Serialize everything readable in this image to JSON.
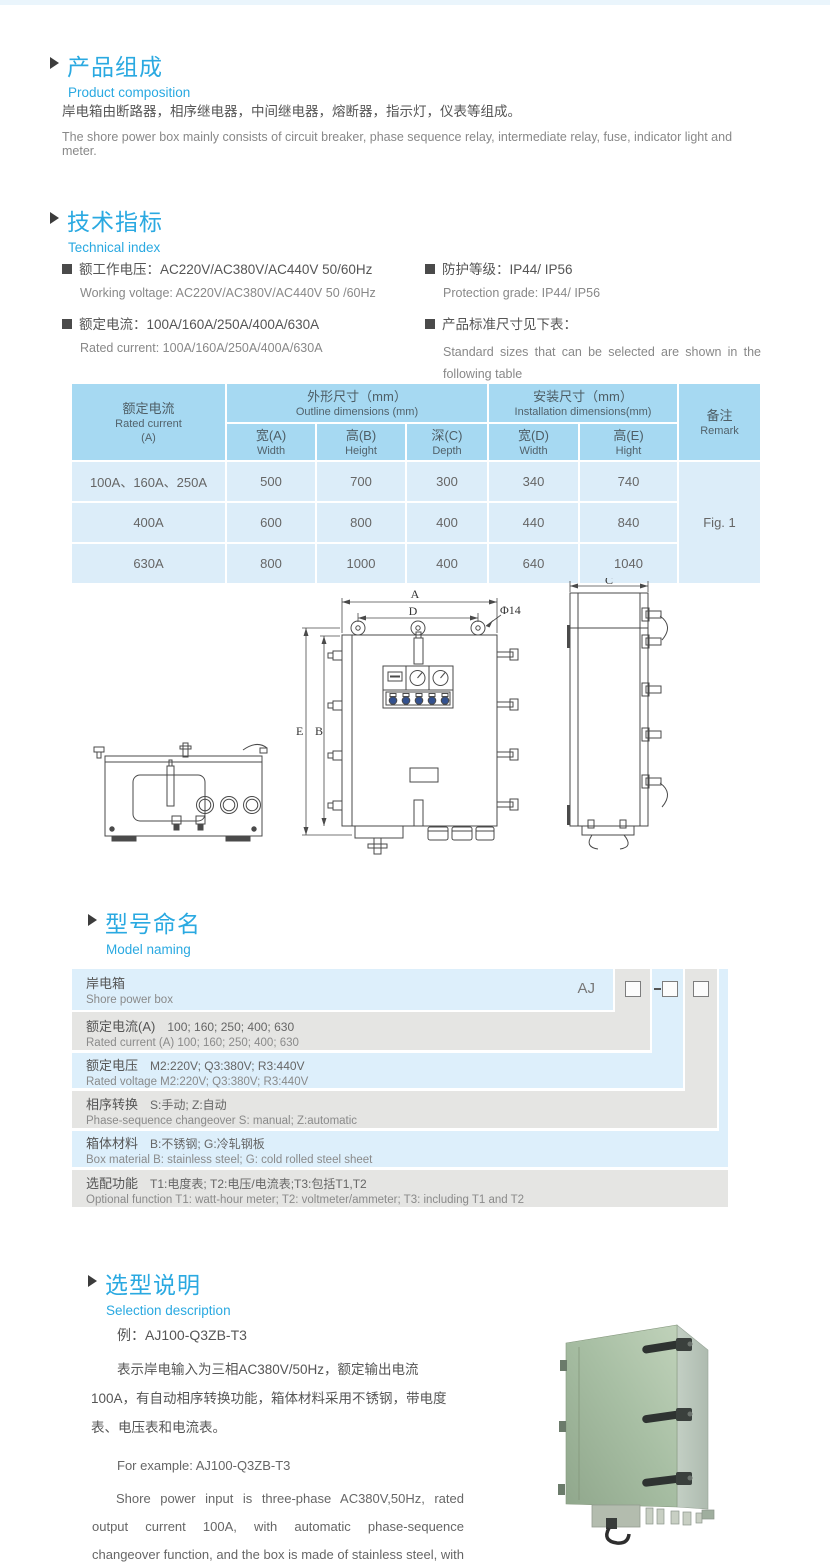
{
  "colors": {
    "accent_blue": "#2aa9e1",
    "table_header_blue": "#a6d9f2",
    "table_row_blue": "#dcedf9",
    "model_gray": "#e5e5e3",
    "model_blue": "#ddeffb",
    "photo_green": "#a8bfa4"
  },
  "composition": {
    "title_zh": "产品组成",
    "title_en": "Product  composition",
    "body_zh": "岸电箱由断路器，相序继电器，中间继电器，熔断器，指示灯，仪表等组成。",
    "body_en": "The shore power box mainly consists of circuit breaker, phase sequence relay, intermediate relay, fuse, indicator light and meter."
  },
  "technical": {
    "title_zh": "技术指标",
    "title_en": "Technical index",
    "specs": [
      {
        "zh": "额工作电压：AC220V/AC380V/AC440V  50/60Hz",
        "en": "Working voltage: AC220V/AC380V/AC440V 50 /60Hz"
      },
      {
        "zh": "额定电流：100A/160A/250A/400A/630A",
        "en": "Rated current: 100A/160A/250A/400A/630A"
      },
      {
        "zh": "防护等级：IP44/ IP56",
        "en": "Protection grade: IP44/ IP56"
      },
      {
        "zh": "产品标准尺寸见下表：",
        "en": "Standard sizes that can be selected are shown in the following table"
      }
    ]
  },
  "dims": {
    "header": {
      "current_zh": "额定电流",
      "current_en": "Rated current",
      "current_unit": "(A)",
      "outline_zh": "外形尺寸（mm）",
      "outline_en": "Outline dimensions (mm)",
      "install_zh": "安装尺寸（mm）",
      "install_en": "Installation dimensions(mm)",
      "remark_zh": "备注",
      "remark_en": "Remark",
      "sub": [
        {
          "zh": "宽(A)",
          "en": "Width"
        },
        {
          "zh": "高(B)",
          "en": "Height"
        },
        {
          "zh": "深(C)",
          "en": "Depth"
        },
        {
          "zh": "宽(D)",
          "en": "Width"
        },
        {
          "zh": "高(E)",
          "en": "Hight"
        }
      ]
    },
    "rows": [
      {
        "current": "100A、160A、250A",
        "values": [
          "500",
          "700",
          "300",
          "340",
          "740"
        ]
      },
      {
        "current": "400A",
        "values": [
          "600",
          "800",
          "400",
          "440",
          "840"
        ]
      },
      {
        "current": "630A",
        "values": [
          "800",
          "1000",
          "400",
          "640",
          "1040"
        ]
      }
    ],
    "remark": "Fig. 1"
  },
  "drawing": {
    "labels": {
      "a": "A",
      "d": "D",
      "hole": "Φ14",
      "e": "E",
      "b": "B",
      "c": "C"
    }
  },
  "model_naming": {
    "title_zh": "型号命名",
    "title_en": "Model naming",
    "prefix": "AJ",
    "rows": [
      {
        "label_zh": "岸电箱",
        "en": "Shore power box"
      },
      {
        "label_zh": "额定电流(A)",
        "detail_zh": "100; 160; 250; 400; 630",
        "en": "Rated current (A) 100; 160; 250; 400; 630"
      },
      {
        "label_zh": "额定电压",
        "detail_zh": "M2:220V;  Q3:380V;  R3:440V",
        "en": "Rated voltage  M2:220V;  Q3:380V;  R3:440V"
      },
      {
        "label_zh": "相序转换",
        "detail_zh": "S:手动; Z:自动",
        "en": "Phase-sequence changeover  S: manual;  Z:automatic"
      },
      {
        "label_zh": "箱体材料",
        "detail_zh": "B:不锈钢;  G:冷轧钢板",
        "en": "Box material   B: stainless steel; G: cold rolled steel sheet"
      },
      {
        "label_zh": "选配功能",
        "detail_zh": "T1:电度表;  T2:电压/电流表;T3:包括T1,T2",
        "en": "Optional function  T1: watt-hour meter; T2: voltmeter/ammeter; T3: including T1 and T2"
      }
    ]
  },
  "selection": {
    "title_zh": "选型说明",
    "title_en": "Selection description",
    "example_zh": "例：AJ100-Q3ZB-T3",
    "desc_zh": "表示岸电输入为三相AC380V/50Hz，额定输出电流100A，有自动相序转换功能，箱体材料采用不锈钢，带电度表、电压表和电流表。",
    "example_en": "For example: AJ100-Q3ZB-T3",
    "desc_en": "Shore power input is three-phase AC380V,50Hz, rated output current 100A, with automatic phase-sequence changeover function, and the box is made of stainless steel, with watt-hour meter, voltmeter and ammeter."
  }
}
